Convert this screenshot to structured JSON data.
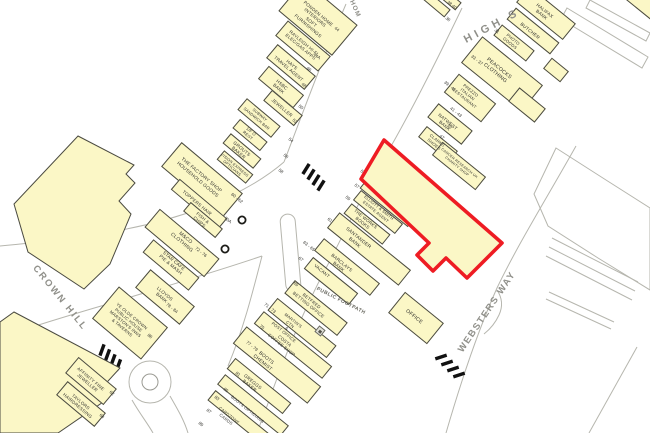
{
  "map_title": "Goad retail plan - Rayleigh High Street",
  "colors": {
    "building_fill": "#FBF7C6",
    "building_outline": "#4a4a40",
    "highlight_red": "#EE1C23",
    "road_line": "#b6b6ae",
    "street_name_text": "#90908a",
    "label_text": "#33332e"
  },
  "street_names": [
    {
      "id": "high-street",
      "text": "HIGH S",
      "x": 492,
      "y": 26,
      "rot": -28,
      "size": 11,
      "ls": 4,
      "color": "#90908a"
    },
    {
      "id": "crown-hill",
      "text": "CROWN HILL",
      "x": 60,
      "y": 298,
      "rot": 51,
      "size": 9.5,
      "ls": 2,
      "color": "#90908a"
    },
    {
      "id": "websters-way",
      "text": "WEBSTERS WAY",
      "x": 487,
      "y": 312,
      "rot": -56,
      "size": 9.5,
      "ls": 1.5,
      "color": "#90908a"
    },
    {
      "id": "public-footpath",
      "text": "PUBLIC FOOTPATH",
      "x": 341,
      "y": 301,
      "rot": 27,
      "size": 5,
      "ls": 0.5,
      "color": "#66665e"
    },
    {
      "id": "hom-road",
      "text": "HOM",
      "x": 355,
      "y": 9,
      "rot": 66,
      "size": 6.5,
      "ls": 1,
      "color": "#90908a"
    }
  ],
  "buildings": [
    {
      "id": "ponden",
      "cx": 318,
      "cy": 18,
      "w": 70,
      "h": 40,
      "rot": 40
    },
    {
      "id": "rayleigh",
      "cx": 303,
      "cy": 46,
      "w": 56,
      "h": 20,
      "rot": 40
    },
    {
      "id": "hays",
      "cx": 291,
      "cy": 67,
      "w": 50,
      "h": 18,
      "rot": 40
    },
    {
      "id": "hsbc",
      "cx": 281,
      "cy": 87,
      "w": 46,
      "h": 17,
      "rot": 40
    },
    {
      "id": "jeweller",
      "cx": 283,
      "cy": 108,
      "w": 40,
      "h": 14,
      "rot": 40
    },
    {
      "id": "subway",
      "cx": 259,
      "cy": 118,
      "w": 44,
      "h": 15,
      "rot": 40
    },
    {
      "id": "first-floor-rest",
      "cx": 250,
      "cy": 135,
      "w": 36,
      "h": 12,
      "rot": 40
    },
    {
      "id": "grouts",
      "cx": 242,
      "cy": 151,
      "w": 40,
      "h": 13,
      "rot": 40
    },
    {
      "id": "vision-express",
      "cx": 235,
      "cy": 167,
      "w": 38,
      "h": 12,
      "rot": 40
    },
    {
      "id": "factory-shop",
      "cx": 202,
      "cy": 180,
      "w": 80,
      "h": 32,
      "rot": 40
    },
    {
      "id": "toppers",
      "cx": 199,
      "cy": 204,
      "w": 62,
      "h": 14,
      "rot": 40
    },
    {
      "id": "fish-chips",
      "cx": 203,
      "cy": 220,
      "w": 42,
      "h": 12,
      "rot": 40
    },
    {
      "id": "m-and-co",
      "cx": 182,
      "cy": 243,
      "w": 78,
      "h": 24,
      "rot": 40
    },
    {
      "id": "star-cafe",
      "cx": 171,
      "cy": 265,
      "w": 60,
      "h": 17,
      "rot": 40
    },
    {
      "id": "lloyds",
      "cx": 165,
      "cy": 297,
      "w": 58,
      "h": 24,
      "rot": 40
    },
    {
      "id": "ye-olde-crown",
      "cx": 130,
      "cy": 323,
      "w": 64,
      "h": 42,
      "rot": 40
    },
    {
      "id": "affinity",
      "cx": 91,
      "cy": 381,
      "w": 50,
      "h": 21,
      "rot": 40
    },
    {
      "id": "taylors",
      "cx": 81,
      "cy": 404,
      "w": 50,
      "h": 18,
      "rot": 40
    },
    {
      "id": "sliver-a",
      "cx": 436,
      "cy": 4,
      "w": 30,
      "h": 10,
      "rot": 40
    },
    {
      "id": "sliver-b",
      "cx": 447,
      "cy": -3,
      "w": 30,
      "h": 10,
      "rot": 40
    },
    {
      "id": "halifax",
      "cx": 546,
      "cy": 13,
      "w": 60,
      "h": 21,
      "rot": 39
    },
    {
      "id": "butcher",
      "cx": 533,
      "cy": 31,
      "w": 56,
      "h": 15,
      "rot": 39
    },
    {
      "id": "photo-goods",
      "cx": 514,
      "cy": 43,
      "w": 42,
      "h": 14,
      "rot": 39
    },
    {
      "id": "peacocks",
      "cx": 502,
      "cy": 74,
      "w": 78,
      "h": 34,
      "rot": 39
    },
    {
      "id": "peacocks-rear",
      "cx": 527,
      "cy": 105,
      "w": 34,
      "h": 18,
      "rot": 39
    },
    {
      "id": "rear-outbuilding",
      "cx": 556,
      "cy": 70,
      "w": 22,
      "h": 14,
      "rot": 39
    },
    {
      "id": "corner-building",
      "cx": 645,
      "cy": 5,
      "w": 36,
      "h": 16,
      "rot": 39
    },
    {
      "id": "prezzo",
      "cx": 470,
      "cy": 98,
      "w": 48,
      "h": 24,
      "rot": 39
    },
    {
      "id": "natwest",
      "cx": 450,
      "cy": 124,
      "w": 44,
      "h": 18,
      "rot": 39
    },
    {
      "id": "clarks",
      "cx": 438,
      "cy": 144,
      "w": 40,
      "h": 14,
      "rot": 39
    },
    {
      "id": "cancer-research",
      "cx": 459,
      "cy": 166,
      "w": 56,
      "h": 17,
      "rot": 39
    },
    {
      "id": "savers",
      "cx": 402,
      "cy": 181,
      "w": 72,
      "h": 32,
      "rot": 39
    },
    {
      "id": "holland-barrett",
      "cx": 389,
      "cy": 201,
      "w": 62,
      "h": 17,
      "rot": 39
    },
    {
      "id": "elliott-smith",
      "cx": 378,
      "cy": 212,
      "w": 54,
      "h": 13,
      "rot": 39
    },
    {
      "id": "the-works",
      "cx": 367,
      "cy": 224,
      "w": 50,
      "h": 13,
      "rot": 39
    },
    {
      "id": "santander",
      "cx": 369,
      "cy": 249,
      "w": 92,
      "h": 20,
      "rot": 39
    },
    {
      "id": "barclays",
      "cx": 347,
      "cy": 267,
      "w": 72,
      "h": 16,
      "rot": 39
    },
    {
      "id": "vacant",
      "cx": 331,
      "cy": 281,
      "w": 58,
      "h": 15,
      "rot": 39
    },
    {
      "id": "betfred",
      "cx": 316,
      "cy": 308,
      "w": 68,
      "h": 17,
      "rot": 39
    },
    {
      "id": "martins",
      "cx": 302,
      "cy": 328,
      "w": 76,
      "h": 16,
      "rot": 39
    },
    {
      "id": "costa",
      "cx": 293,
      "cy": 345,
      "w": 88,
      "h": 16,
      "rot": 39
    },
    {
      "id": "boots-chemist",
      "cx": 277,
      "cy": 365,
      "w": 96,
      "h": 22,
      "rot": 39
    },
    {
      "id": "greggs",
      "cx": 259,
      "cy": 386,
      "w": 72,
      "h": 14,
      "rot": 39
    },
    {
      "id": "boots-opticians",
      "cx": 253,
      "cy": 405,
      "w": 82,
      "h": 13,
      "rot": 39
    },
    {
      "id": "cardzone",
      "cx": 241,
      "cy": 419,
      "w": 76,
      "h": 13,
      "rot": 39
    },
    {
      "id": "office",
      "cx": 416,
      "cy": 318,
      "w": 50,
      "h": 27,
      "rot": 39
    }
  ],
  "shop_labels": [
    {
      "id": "ponden",
      "lines": [
        "PONDEN HOME",
        "INTERIORS",
        "SOFT",
        "FURNISHINGS"
      ],
      "x": 313,
      "y": 20,
      "rot": 40,
      "size": 4.6
    },
    {
      "id": "rayleigh",
      "lines": [
        "RAYLEIGH HI-FI",
        "ELEC/GAS APPS"
      ],
      "x": 302,
      "y": 45,
      "rot": 40,
      "size": 4.5
    },
    {
      "id": "hays",
      "lines": [
        "HAYS",
        "TRAVEL AGENT"
      ],
      "x": 290,
      "y": 67,
      "rot": 40,
      "size": 4.6
    },
    {
      "id": "hsbc",
      "lines": [
        "HSBC",
        "BANK"
      ],
      "x": 280,
      "y": 87,
      "rot": 40,
      "size": 4.6
    },
    {
      "id": "jeweller",
      "lines": [
        "JEWELLER"
      ],
      "x": 282,
      "y": 108,
      "rot": 40,
      "size": 4.6
    },
    {
      "id": "subway",
      "lines": [
        "SUBWAY",
        "SANDWICH BAR"
      ],
      "x": 258,
      "y": 117,
      "rot": 40,
      "size": 3.9
    },
    {
      "id": "first-floor-rest",
      "lines": [
        "1/F O",
        "REST"
      ],
      "x": 249,
      "y": 134,
      "rot": 40,
      "size": 4.1
    },
    {
      "id": "grouts",
      "lines": [
        "GROUTS",
        "BAKER"
      ],
      "x": 240,
      "y": 151,
      "rot": 40,
      "size": 4.6
    },
    {
      "id": "vision-express",
      "lines": [
        "VISION EXPRESS",
        "OPTICIANS"
      ],
      "x": 233,
      "y": 167,
      "rot": 40,
      "size": 3.8
    },
    {
      "id": "factory-shop",
      "lines": [
        "THE FACTORY SHOP",
        "HOUSEHOLD GOODS"
      ],
      "x": 199,
      "y": 178,
      "rot": 40,
      "size": 4.8
    },
    {
      "id": "toppers",
      "lines": [
        "TOPPERS HAIR"
      ],
      "x": 197,
      "y": 203,
      "rot": 40,
      "size": 4.6
    },
    {
      "id": "fish-chips",
      "lines": [
        "FISH &",
        "CHIPS"
      ],
      "x": 201,
      "y": 220,
      "rot": 40,
      "size": 4.4
    },
    {
      "id": "m-and-co",
      "lines": [
        "M&CO",
        "CLOTHING"
      ],
      "x": 183,
      "y": 241,
      "rot": 40,
      "size": 5.0
    },
    {
      "id": "star-cafe",
      "lines": [
        "STAR CAFE",
        "PIE & MASH"
      ],
      "x": 172,
      "y": 263,
      "rot": 40,
      "size": 4.6
    },
    {
      "id": "lloyds",
      "lines": [
        "LLOYDS",
        "BANK"
      ],
      "x": 163,
      "y": 296,
      "rot": 40,
      "size": 4.6
    },
    {
      "id": "ye-olde-crown",
      "lines": [
        "YE OLDE CROWN",
        "PUBLIC HOUSE",
        "MARSTON'S INNS",
        "& TAVERNS"
      ],
      "x": 127,
      "y": 322,
      "rot": 40,
      "size": 4.3
    },
    {
      "id": "affinity",
      "lines": [
        "AFFINITY FINE",
        "JEWELLER"
      ],
      "x": 89,
      "y": 381,
      "rot": 40,
      "size": 4.5
    },
    {
      "id": "taylors",
      "lines": [
        "TAYLORS",
        "HAIRDRESSING"
      ],
      "x": 79,
      "y": 404,
      "rot": 40,
      "size": 4.5
    },
    {
      "id": "halifax",
      "lines": [
        "HALIFAX",
        "BANK"
      ],
      "x": 543,
      "y": 13,
      "rot": 39,
      "size": 4.6
    },
    {
      "id": "butcher",
      "lines": [
        "BUTCHER"
      ],
      "x": 530,
      "y": 31,
      "rot": 39,
      "size": 4.6
    },
    {
      "id": "photo-goods",
      "lines": [
        "PHOTO",
        "GOODS"
      ],
      "x": 511,
      "y": 42,
      "rot": 39,
      "size": 4.2
    },
    {
      "id": "peacocks",
      "lines": [
        "PEACOCKS",
        "CLOTHING"
      ],
      "x": 497,
      "y": 71,
      "rot": 39,
      "size": 5.2
    },
    {
      "id": "prezzo",
      "lines": [
        "PREZZO",
        "ITALIAN",
        "RESTAURANT"
      ],
      "x": 467,
      "y": 95,
      "rot": 39,
      "size": 4.2
    },
    {
      "id": "natwest",
      "lines": [
        "NATWEST",
        "BANK"
      ],
      "x": 446,
      "y": 124,
      "rot": 39,
      "size": 4.6
    },
    {
      "id": "clarks",
      "lines": [
        "CLARKS",
        "SHOES"
      ],
      "x": 435,
      "y": 143,
      "rot": 39,
      "size": 4.2
    },
    {
      "id": "cancer-research",
      "lines": [
        "CANCER RESEARCH UK",
        "CHARITY SHOP"
      ],
      "x": 458,
      "y": 165,
      "rot": 39,
      "size": 3.6
    },
    {
      "id": "savers",
      "lines": [
        "SAVERS",
        "HEALTH & BEAUTY"
      ],
      "x": 401,
      "y": 176,
      "rot": 39,
      "size": 4.8
    },
    {
      "id": "holland-barrett",
      "lines": [
        "HOLLAND & BARRETT",
        "HEALTH FOOD"
      ],
      "x": 388,
      "y": 198,
      "rot": 39,
      "size": 4.2
    },
    {
      "id": "elliott-smith",
      "lines": [
        "ELLIOTT & SMITH",
        "ESTATE AGENT"
      ],
      "x": 377,
      "y": 210,
      "rot": 39,
      "size": 4.0
    },
    {
      "id": "the-works",
      "lines": [
        "THE WORKS",
        "BOOKS"
      ],
      "x": 364,
      "y": 221,
      "rot": 39,
      "size": 4.4
    },
    {
      "id": "santander",
      "lines": [
        "SANTANDER",
        "BANK"
      ],
      "x": 356,
      "y": 241,
      "rot": 39,
      "size": 4.8
    },
    {
      "id": "barclays",
      "lines": [
        "BARCLAYS",
        "BANK"
      ],
      "x": 340,
      "y": 265,
      "rot": 39,
      "size": 4.6
    },
    {
      "id": "vacant",
      "lines": [
        "VACANT"
      ],
      "x": 322,
      "y": 271,
      "rot": 39,
      "size": 4.4
    },
    {
      "id": "betfred",
      "lines": [
        "BETFRED",
        "BETTING OFFICE"
      ],
      "x": 310,
      "y": 303,
      "rot": 39,
      "size": 4.4
    },
    {
      "id": "martins",
      "lines": [
        "MARTIN'S",
        "CTN",
        "&",
        "POST OFFICE"
      ],
      "x": 288,
      "y": 327,
      "rot": 39,
      "size": 4.2
    },
    {
      "id": "costa",
      "lines": [
        "COSTA",
        "COFFEE SHOP"
      ],
      "x": 283,
      "y": 343,
      "rot": 39,
      "size": 4.4
    },
    {
      "id": "boots-chemist",
      "lines": [
        "BOOTS",
        "CHEMIST"
      ],
      "x": 264,
      "y": 361,
      "rot": 39,
      "size": 4.8
    },
    {
      "id": "greggs",
      "lines": [
        "GREGGS",
        "BAKER"
      ],
      "x": 251,
      "y": 384,
      "rot": 39,
      "size": 4.6
    },
    {
      "id": "boots-opticians",
      "lines": [
        "BOOTS OPTICIANS"
      ],
      "x": 247,
      "y": 410,
      "rot": 39,
      "size": 4.2
    },
    {
      "id": "cardzone",
      "lines": [
        "CARDZONE",
        "CARDS"
      ],
      "x": 227,
      "y": 418,
      "rot": 39,
      "size": 4.2
    },
    {
      "id": "office",
      "lines": [
        "OFFICE"
      ],
      "x": 414,
      "y": 317,
      "rot": 39,
      "size": 5.2
    }
  ],
  "street_numbers": [
    {
      "text": "44",
      "x": 337,
      "y": 29
    },
    {
      "text": "44A",
      "x": 317,
      "y": 56
    },
    {
      "text": "46",
      "x": 309,
      "y": 69
    },
    {
      "text": "48",
      "x": 304,
      "y": 85
    },
    {
      "text": "50",
      "x": 301,
      "y": 107
    },
    {
      "text": "52",
      "x": 295,
      "y": 121
    },
    {
      "text": "54",
      "x": 291,
      "y": 140
    },
    {
      "text": "56",
      "x": 286,
      "y": 156
    },
    {
      "text": "58",
      "x": 281,
      "y": 171
    },
    {
      "text": "60 - 62",
      "x": 237,
      "y": 198
    },
    {
      "text": "70A",
      "x": 228,
      "y": 220
    },
    {
      "text": "72 - 76",
      "x": 201,
      "y": 252
    },
    {
      "text": "78 - 84",
      "x": 172,
      "y": 308
    },
    {
      "text": "86",
      "x": 150,
      "y": 336
    },
    {
      "text": "62",
      "x": 112,
      "y": 393
    },
    {
      "text": "64",
      "x": 102,
      "y": 416
    },
    {
      "text": "36",
      "x": 448,
      "y": 19
    },
    {
      "text": "38  40",
      "x": 452,
      "y": 5
    },
    {
      "text": "31",
      "x": 497,
      "y": 31
    },
    {
      "text": "33 - 37",
      "x": 477,
      "y": 60
    },
    {
      "text": "39 - 41",
      "x": 450,
      "y": 86
    },
    {
      "text": "41 - 43",
      "x": 456,
      "y": 112
    },
    {
      "text": "45",
      "x": 450,
      "y": 126
    },
    {
      "text": "47",
      "x": 442,
      "y": 137
    },
    {
      "text": "49 - 53",
      "x": 386,
      "y": 155
    },
    {
      "text": "55",
      "x": 363,
      "y": 172
    },
    {
      "text": "57",
      "x": 357,
      "y": 186
    },
    {
      "text": "59",
      "x": 348,
      "y": 198
    },
    {
      "text": "61",
      "x": 330,
      "y": 220
    },
    {
      "text": "63 - 65",
      "x": 309,
      "y": 246
    },
    {
      "text": "67",
      "x": 301,
      "y": 259
    },
    {
      "text": "69",
      "x": 296,
      "y": 284
    },
    {
      "text": "71 - 73",
      "x": 270,
      "y": 308
    },
    {
      "text": "75",
      "x": 262,
      "y": 327
    },
    {
      "text": "77 - 79",
      "x": 252,
      "y": 346
    },
    {
      "text": "81",
      "x": 238,
      "y": 374
    },
    {
      "text": "85",
      "x": 226,
      "y": 390
    },
    {
      "text": "83",
      "x": 217,
      "y": 398
    },
    {
      "text": "87",
      "x": 209,
      "y": 411
    },
    {
      "text": "89",
      "x": 201,
      "y": 424
    }
  ],
  "symbols": [
    {
      "id": "post-office-symbol",
      "x": 320,
      "y": 331,
      "rot": 39
    }
  ],
  "highlight": {
    "description": "Red outlined subject property (49-53 with rear block)",
    "points": "384,140 502,243 467,278 446,258 433,271 417,255 429,243 361,179"
  }
}
